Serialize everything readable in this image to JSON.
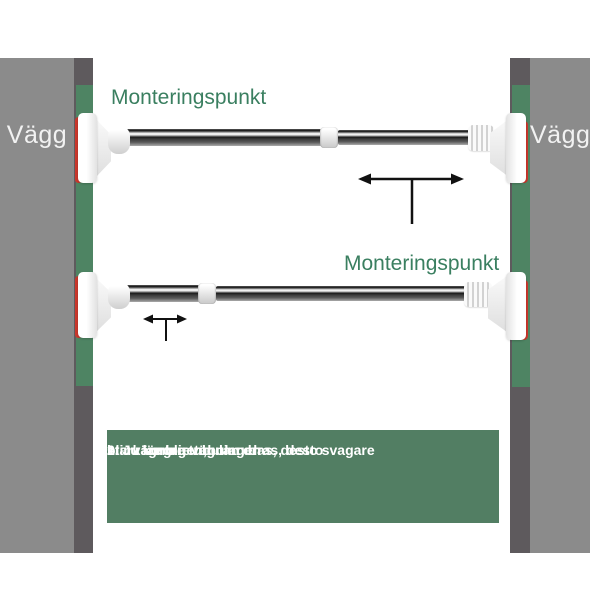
{
  "walls": {
    "left_label": "Vägg",
    "right_label": "Vägg"
  },
  "mount_labels": {
    "top": "Monteringspunkt",
    "bottom": "Monteringspunkt"
  },
  "instructions": {
    "line1": "1. Ju längre tubulan dras, desto svagare",
    "line2": "blir vägningen;",
    "line3": "2. Ju kortare tubulan dras, desto",
    "line4": "starkare blir vägningen"
  },
  "icons": {
    "top_rod_arrow": "extend-double-arrow-icon",
    "bottom_rod_arrow": "extend-double-arrow-icon"
  },
  "colors": {
    "wall_gray": "#8b8b8b",
    "wall_edge_dark": "#5e5a5d",
    "mount_strip_green": "#4e8463",
    "label_green": "#3a7f60",
    "instruction_box_green": "#527e63",
    "accent_red": "#c9372c",
    "arrow_black": "#111111"
  }
}
